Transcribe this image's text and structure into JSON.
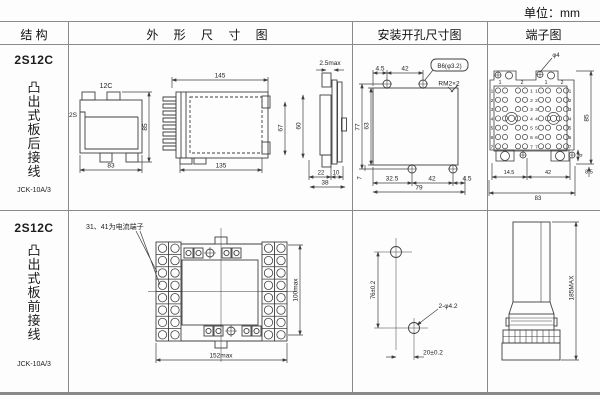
{
  "unit_label": "单位：mm",
  "header": {
    "structure": "结 构",
    "outline": "外 形 尺 寸 图",
    "mounting": "安装开孔尺寸图",
    "terminal": "端子图"
  },
  "rows": [
    {
      "model": "2S12C",
      "type_text": "凸\n出\n式\n板\n后\n接\n线",
      "code": "JCK-10A/3"
    },
    {
      "model": "2S12C",
      "type_text": "凸\n出\n式\n板\n前\n接\n线",
      "code": "JCK-10A/3"
    }
  ],
  "row1": {
    "outline": {
      "front_top": "12C",
      "front_side": "2S",
      "front_width": "83",
      "front_height": "85",
      "side_total": "145",
      "side_body": "135",
      "side_inner_h": "67",
      "side_rear_h": "60",
      "panel_thickness": "2.5max",
      "rear_depth": "22",
      "clamp_depth": "10",
      "behind_panel": "38"
    },
    "mounting": {
      "top_offset": "4.5",
      "top_span": "42",
      "hole_note": "B6(φ3.2)",
      "thread_note": "RM2×2",
      "total_h": "77",
      "cutout_h": "63",
      "bottom_offset_v": "7",
      "bottom_seg1": "32.5",
      "bottom_seg2": "42",
      "bottom_seg3": "4.5",
      "bottom_total": "79"
    },
    "terminal": {
      "hole_note": "φ4",
      "height": "85",
      "foot_offset": "4",
      "bottom_seg1": "14.5",
      "bottom_seg2": "42",
      "side_offset": "8.5",
      "width": "83",
      "col_labels": [
        "1",
        "2",
        "1",
        "2"
      ],
      "row_labels": [
        "1",
        "2",
        "3",
        "4",
        "5",
        "6",
        "7"
      ]
    }
  },
  "row2": {
    "outline": {
      "note": "31、41为电流端子",
      "height": "100max",
      "width": "152max"
    },
    "mounting": {
      "vertical": "76±0.2",
      "holes": "2-φ4.2",
      "horizontal": "20±0.2"
    },
    "terminal": {
      "height": "185MAX"
    }
  }
}
